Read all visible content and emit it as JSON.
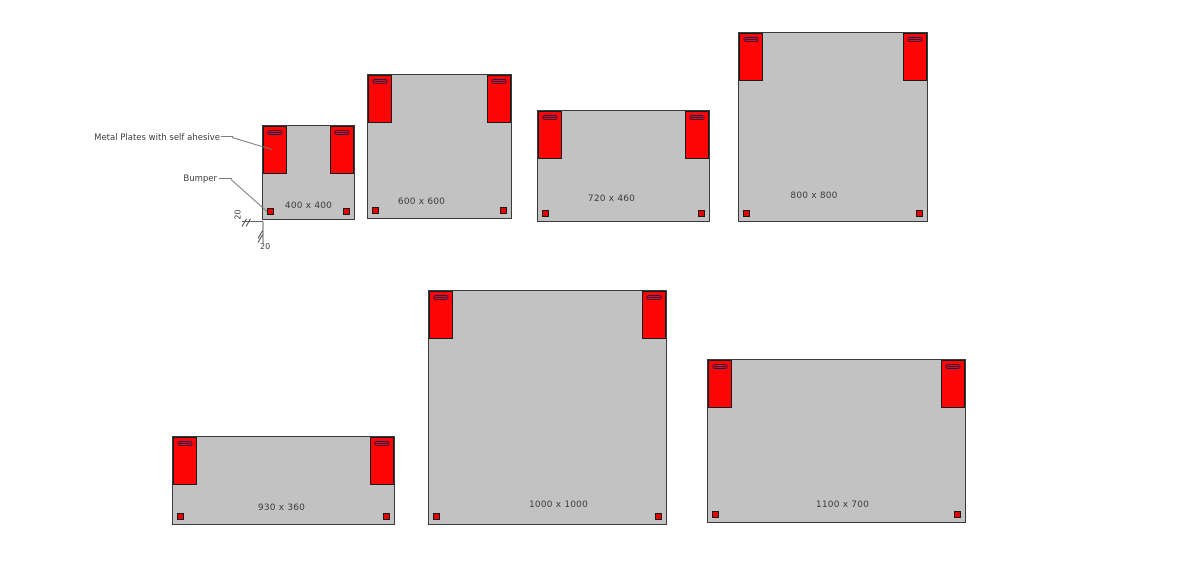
{
  "diagram": {
    "annotations": {
      "metal_plates_label": "Metal Plates with self ahesive",
      "bumper_label": "Bumper",
      "dim_left": "20",
      "dim_bottom": "20"
    },
    "panels": [
      {
        "id": "400x400",
        "label": "400 x 400",
        "width_mm": 400,
        "height_mm": 400
      },
      {
        "id": "600x600",
        "label": "600 x 600",
        "width_mm": 600,
        "height_mm": 600
      },
      {
        "id": "720x460",
        "label": "720 x 460",
        "width_mm": 720,
        "height_mm": 460
      },
      {
        "id": "800x800",
        "label": "800 x 800",
        "width_mm": 800,
        "height_mm": 800
      },
      {
        "id": "930x360",
        "label": "930 x 360",
        "width_mm": 930,
        "height_mm": 360
      },
      {
        "id": "1000x1000",
        "label": "1000 x 1000",
        "width_mm": 1000,
        "height_mm": 1000
      },
      {
        "id": "1100x700",
        "label": "1100 x 700",
        "width_mm": 1100,
        "height_mm": 700
      }
    ],
    "colors": {
      "background": "#ffffff",
      "panel_fill": "#c2c2c2",
      "panel_border": "#3a3a3a",
      "plate_fill": "#fb0505",
      "plate_border": "#1a1a1a",
      "slot_color": "#1b1b52",
      "bumper_fill": "#e60000",
      "text": "#3c3c3c"
    }
  }
}
